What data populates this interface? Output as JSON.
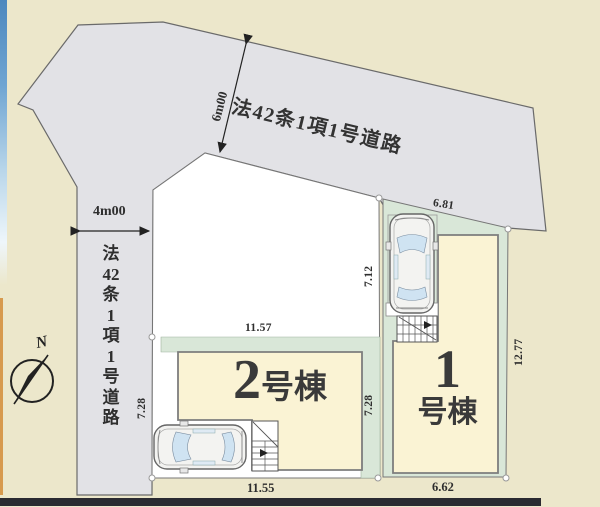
{
  "roads": {
    "diagonal": {
      "label": "法42条1項1号道路",
      "width_label": "6m00"
    },
    "vertical": {
      "label": "法42条1項1号道路",
      "chars": [
        "法",
        "42",
        "条",
        "1",
        "項",
        "1",
        "号",
        "道",
        "路"
      ],
      "width_label": "4m00"
    }
  },
  "compass": {
    "north": "N"
  },
  "lot1": {
    "number": "1",
    "suffix": "号棟",
    "dim_top": "6.81",
    "dim_upper_left": "7.12",
    "dim_lower_left": "7.28",
    "dim_right": "12.77",
    "dim_bottom": "6.62"
  },
  "lot2": {
    "number": "2",
    "suffix": "号棟",
    "dim_top": "11.57",
    "dim_left": "7.28",
    "dim_bottom": "11.55"
  },
  "colors": {
    "background": "#ece7cb",
    "road": "#e2e2e6",
    "lot_green": "#d9e7d8",
    "building": "#faf3d4",
    "bottom_bar": "#2a2a31",
    "edge_blue": "#4d88be",
    "edge_orange": "#d79a4e"
  }
}
